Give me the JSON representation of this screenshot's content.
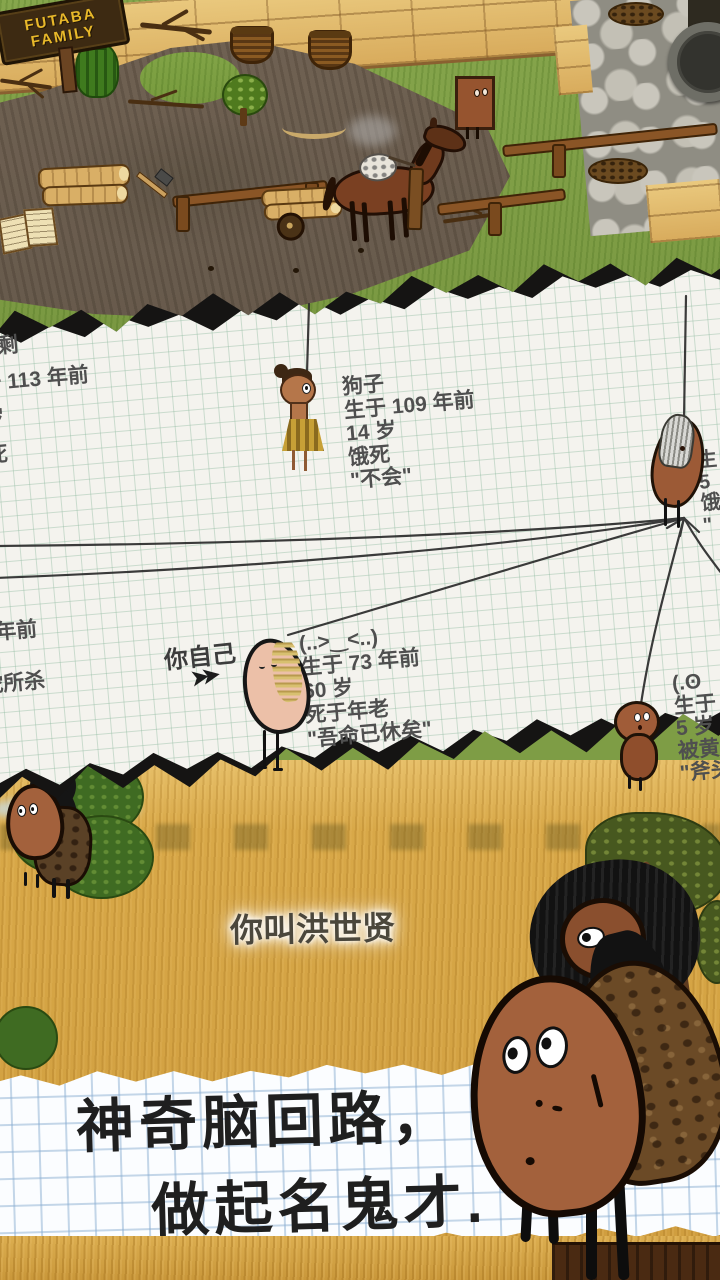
{
  "top_scene": {
    "sign": {
      "line1": "FUTABA",
      "line2": "FAMILY"
    }
  },
  "family_tree": {
    "left_block_top": {
      "lines": [
        "剩",
        "于 113 年前",
        "岁",
        "死"
      ]
    },
    "left_block_bottom": {
      "lines": [
        "7 年前",
        "蛇所杀"
      ]
    },
    "dog_child": {
      "lines": [
        "狗子",
        "生于 109 年前",
        "14 岁",
        "饿死",
        "\"不会\""
      ]
    },
    "you_label": "你自己",
    "you_arrow": "➤➤",
    "you": {
      "lines": [
        "(..>‿<..)",
        "生于 73 年前",
        "60 岁",
        "死于年老",
        "\"吾命已休矣\""
      ]
    },
    "elder_right": {
      "lines": [
        "生",
        "5",
        "饿",
        "\""
      ]
    },
    "child_right": {
      "lines": [
        "(.ʘ",
        "生于",
        "5 岁",
        "被黄",
        "\"斧头"
      ]
    }
  },
  "savanna": {
    "speech": "你叫洪世贤"
  },
  "caption": {
    "line1": "神奇脑回路，",
    "line2": "做起名鬼才."
  },
  "colors": {
    "grass": "#86a64c",
    "dirt": "#6f6152",
    "wood": "#e2bb72",
    "stone": "#b5b2a8",
    "paper": "#f4f3ee",
    "ink": "#4f4f4f",
    "banner_paper": "#fbfdff",
    "banner_text": "#1f1f1f",
    "savanna": "#d8a848",
    "sign_text": "#e8b82a"
  }
}
